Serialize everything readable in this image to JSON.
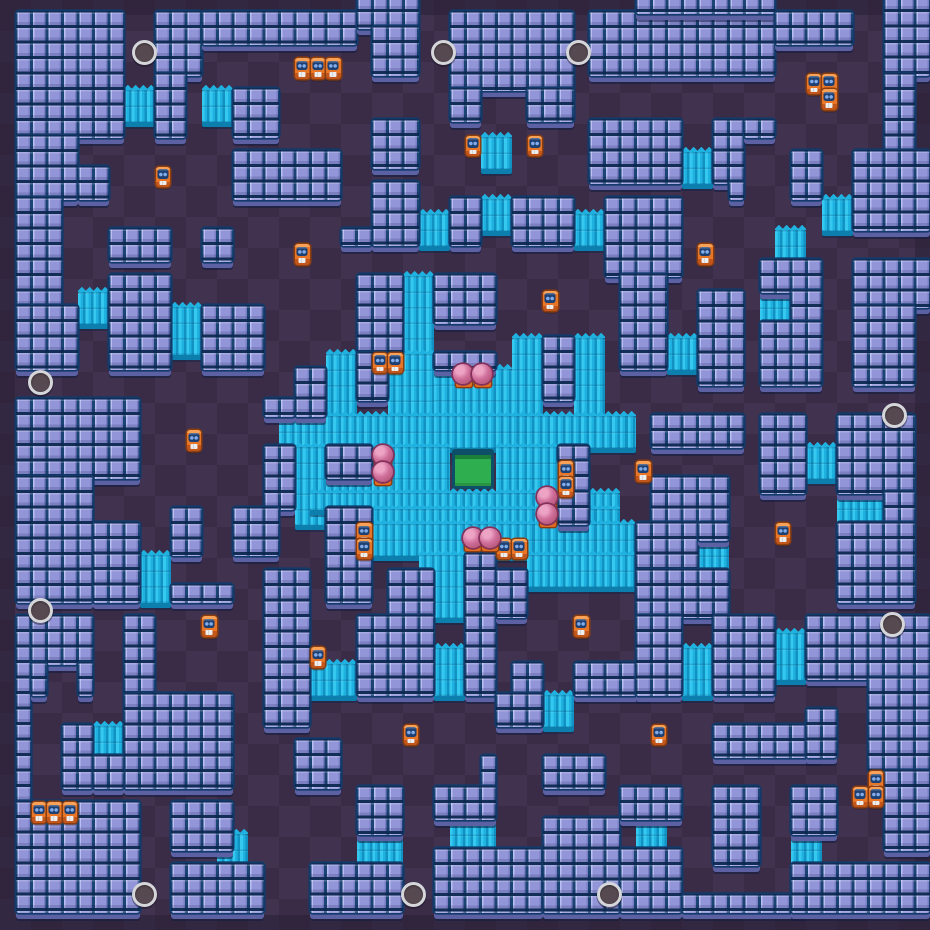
{
  "map": {
    "grid": {
      "cols": 60,
      "rows": 60,
      "tile_px": 15.5
    },
    "colors": {
      "bg_dark": "#3a2c47",
      "bg_light": "#41324f",
      "rim": "#261d33",
      "wall_face": "#8f93da",
      "wall_lip": "#5c61a3",
      "bush_a": "#36c9f0",
      "bush_b": "#1fb2e0",
      "bush_c": "#1292c2",
      "bush_lip": "#0d7fae",
      "crate_body": "#e87628",
      "crate_top": "#f9a257",
      "crate_border": "#8a3d0e",
      "crate_face": "#1d3f72",
      "crate_eye": "#82abe9",
      "ball_fill": "#d0709b",
      "ball_edge": "#83305b",
      "ball_base": "#dd6b20",
      "spawn_ring": "#d5d6da",
      "spawn_fill": "#574950",
      "gem_fill": "#2fae4f",
      "gem_edge": "#0d4f68"
    },
    "walls": [
      [
        1,
        1,
        7,
        8
      ],
      [
        1,
        9,
        4,
        4
      ],
      [
        1,
        13,
        3,
        7
      ],
      [
        5,
        11,
        2,
        2
      ],
      [
        10,
        1,
        3,
        4
      ],
      [
        10,
        5,
        2,
        4
      ],
      [
        13,
        1,
        10,
        2
      ],
      [
        15,
        6,
        3,
        3
      ],
      [
        15,
        10,
        7,
        3
      ],
      [
        7,
        15,
        4,
        2
      ],
      [
        13,
        15,
        2,
        2
      ],
      [
        7,
        18,
        4,
        6
      ],
      [
        23,
        0,
        4,
        2
      ],
      [
        24,
        2,
        3,
        3
      ],
      [
        29,
        1,
        8,
        5
      ],
      [
        29,
        6,
        2,
        2
      ],
      [
        34,
        6,
        3,
        2
      ],
      [
        24,
        8,
        3,
        3
      ],
      [
        24,
        12,
        3,
        4
      ],
      [
        22,
        15,
        2,
        1
      ],
      [
        29,
        13,
        2,
        3
      ],
      [
        33,
        13,
        4,
        3
      ],
      [
        38,
        1,
        12,
        4
      ],
      [
        41,
        0,
        9,
        1
      ],
      [
        50,
        1,
        5,
        2
      ],
      [
        57,
        0,
        3,
        5
      ],
      [
        57,
        5,
        2,
        5
      ],
      [
        38,
        8,
        6,
        4
      ],
      [
        46,
        8,
        2,
        4
      ],
      [
        48,
        8,
        2,
        1
      ],
      [
        47,
        12,
        1,
        1
      ],
      [
        51,
        10,
        2,
        3
      ],
      [
        55,
        10,
        5,
        5
      ],
      [
        39,
        13,
        5,
        5
      ],
      [
        49,
        17,
        4,
        2
      ],
      [
        51,
        19,
        2,
        2
      ],
      [
        55,
        17,
        5,
        3
      ],
      [
        1,
        20,
        4,
        4
      ],
      [
        13,
        20,
        4,
        4
      ],
      [
        19,
        24,
        2,
        3
      ],
      [
        17,
        26,
        2,
        1
      ],
      [
        1,
        26,
        8,
        5
      ],
      [
        1,
        31,
        5,
        8
      ],
      [
        6,
        34,
        3,
        5
      ],
      [
        11,
        38,
        4,
        1
      ],
      [
        17,
        29,
        2,
        4
      ],
      [
        11,
        33,
        2,
        3
      ],
      [
        15,
        33,
        3,
        3
      ],
      [
        23,
        18,
        3,
        5
      ],
      [
        23,
        23,
        2,
        3
      ],
      [
        28,
        18,
        4,
        3
      ],
      [
        28,
        23,
        4,
        1
      ],
      [
        35,
        22,
        2,
        4
      ],
      [
        21,
        29,
        3,
        2
      ],
      [
        36,
        29,
        2,
        1
      ],
      [
        37,
        30,
        1,
        2
      ],
      [
        36,
        32,
        2,
        2
      ],
      [
        21,
        33,
        3,
        6
      ],
      [
        30,
        36,
        2,
        9
      ],
      [
        25,
        37,
        3,
        3
      ],
      [
        32,
        37,
        2,
        3
      ],
      [
        40,
        18,
        3,
        6
      ],
      [
        45,
        19,
        3,
        6
      ],
      [
        49,
        21,
        4,
        4
      ],
      [
        55,
        20,
        4,
        5
      ],
      [
        42,
        27,
        6,
        2
      ],
      [
        49,
        27,
        3,
        5
      ],
      [
        54,
        27,
        5,
        5
      ],
      [
        57,
        32,
        2,
        2
      ],
      [
        54,
        34,
        5,
        5
      ],
      [
        42,
        31,
        5,
        3
      ],
      [
        41,
        34,
        4,
        3
      ],
      [
        45,
        34,
        2,
        1
      ],
      [
        41,
        37,
        6,
        3
      ],
      [
        1,
        40,
        1,
        12
      ],
      [
        2,
        40,
        4,
        3
      ],
      [
        2,
        43,
        1,
        2
      ],
      [
        5,
        43,
        1,
        2
      ],
      [
        8,
        40,
        2,
        5
      ],
      [
        8,
        45,
        7,
        6
      ],
      [
        4,
        47,
        2,
        4
      ],
      [
        6,
        49,
        2,
        2
      ],
      [
        1,
        52,
        8,
        7
      ],
      [
        11,
        52,
        4,
        3
      ],
      [
        11,
        56,
        6,
        3
      ],
      [
        17,
        37,
        3,
        10
      ],
      [
        23,
        40,
        5,
        5
      ],
      [
        33,
        43,
        2,
        2
      ],
      [
        32,
        45,
        3,
        2
      ],
      [
        37,
        43,
        5,
        2
      ],
      [
        19,
        48,
        3,
        3
      ],
      [
        23,
        51,
        3,
        3
      ],
      [
        31,
        49,
        1,
        2
      ],
      [
        28,
        51,
        4,
        2
      ],
      [
        20,
        56,
        6,
        3
      ],
      [
        28,
        55,
        7,
        4
      ],
      [
        35,
        49,
        4,
        2
      ],
      [
        35,
        53,
        5,
        6
      ],
      [
        41,
        40,
        3,
        5
      ],
      [
        46,
        40,
        4,
        5
      ],
      [
        52,
        40,
        8,
        4
      ],
      [
        56,
        44,
        4,
        6
      ],
      [
        57,
        50,
        3,
        5
      ],
      [
        46,
        47,
        7,
        2
      ],
      [
        52,
        46,
        2,
        3
      ],
      [
        40,
        51,
        4,
        2
      ],
      [
        40,
        55,
        4,
        4
      ],
      [
        44,
        58,
        8,
        1
      ],
      [
        46,
        51,
        3,
        5
      ],
      [
        51,
        51,
        3,
        3
      ],
      [
        51,
        56,
        9,
        3
      ]
    ],
    "bushes": [
      [
        8,
        6,
        2,
        2
      ],
      [
        13,
        6,
        2,
        2
      ],
      [
        31,
        9,
        2,
        2
      ],
      [
        44,
        10,
        2,
        2
      ],
      [
        27,
        14,
        2,
        2
      ],
      [
        31,
        13,
        2,
        2
      ],
      [
        37,
        14,
        2,
        2
      ],
      [
        53,
        13,
        2,
        2
      ],
      [
        50,
        15,
        2,
        2
      ],
      [
        5,
        19,
        2,
        2
      ],
      [
        11,
        20,
        2,
        3
      ],
      [
        49,
        19,
        2,
        2
      ],
      [
        43,
        22,
        2,
        2
      ],
      [
        26,
        18,
        2,
        5
      ],
      [
        21,
        23,
        2,
        4
      ],
      [
        25,
        23,
        3,
        4
      ],
      [
        28,
        24,
        5,
        3
      ],
      [
        33,
        22,
        2,
        5
      ],
      [
        37,
        22,
        2,
        5
      ],
      [
        18,
        27,
        23,
        2
      ],
      [
        19,
        29,
        2,
        5
      ],
      [
        24,
        29,
        5,
        3
      ],
      [
        32,
        29,
        4,
        3
      ],
      [
        21,
        31,
        3,
        1
      ],
      [
        20,
        32,
        20,
        1
      ],
      [
        24,
        33,
        16,
        1
      ],
      [
        24,
        34,
        17,
        2
      ],
      [
        34,
        36,
        7,
        2
      ],
      [
        27,
        36,
        3,
        4
      ],
      [
        9,
        36,
        2,
        3
      ],
      [
        52,
        29,
        2,
        2
      ],
      [
        54,
        32,
        3,
        2
      ],
      [
        28,
        42,
        2,
        3
      ],
      [
        20,
        43,
        3,
        2
      ],
      [
        44,
        42,
        2,
        3
      ],
      [
        50,
        41,
        2,
        3
      ],
      [
        45,
        35,
        2,
        2
      ],
      [
        41,
        53,
        2,
        2
      ],
      [
        51,
        54,
        2,
        2
      ],
      [
        35,
        45,
        2,
        2
      ],
      [
        6,
        47,
        2,
        2
      ],
      [
        14,
        54,
        2,
        2
      ],
      [
        23,
        54,
        3,
        2
      ],
      [
        29,
        53,
        3,
        2
      ]
    ],
    "crates": [
      [
        19,
        4
      ],
      [
        20,
        4
      ],
      [
        21,
        4
      ],
      [
        10,
        11
      ],
      [
        19,
        16
      ],
      [
        30,
        9
      ],
      [
        34,
        9
      ],
      [
        35,
        19
      ],
      [
        24,
        23
      ],
      [
        25,
        23
      ],
      [
        52,
        5
      ],
      [
        53,
        5
      ],
      [
        53,
        6
      ],
      [
        45,
        16
      ],
      [
        12,
        28
      ],
      [
        36,
        30
      ],
      [
        36,
        31
      ],
      [
        23,
        34
      ],
      [
        23,
        35
      ],
      [
        32,
        35
      ],
      [
        33,
        35
      ],
      [
        41,
        30
      ],
      [
        50,
        34
      ],
      [
        13,
        40
      ],
      [
        2,
        52
      ],
      [
        3,
        52
      ],
      [
        4,
        52
      ],
      [
        20,
        42
      ],
      [
        26,
        47
      ],
      [
        37,
        40
      ],
      [
        42,
        47
      ],
      [
        56,
        50
      ],
      [
        55,
        51
      ],
      [
        56,
        51
      ]
    ],
    "balls": [
      [
        29.9,
        24.2
      ],
      [
        31.1,
        24.2
      ],
      [
        24.7,
        29.4
      ],
      [
        24.7,
        30.5
      ],
      [
        35.3,
        32.1
      ],
      [
        35.3,
        33.2
      ],
      [
        30.5,
        34.8
      ],
      [
        31.6,
        34.8
      ]
    ],
    "spawns": [
      [
        9.3,
        3.4
      ],
      [
        28.6,
        3.4
      ],
      [
        37.3,
        3.4
      ],
      [
        2.6,
        24.7
      ],
      [
        2.6,
        39.4
      ],
      [
        57.7,
        26.8
      ],
      [
        57.6,
        40.3
      ],
      [
        9.3,
        57.7
      ],
      [
        26.7,
        57.7
      ],
      [
        39.3,
        57.7
      ]
    ],
    "gem_spawner": [
      29.15,
      28.95,
      2.7,
      2.6
    ]
  }
}
